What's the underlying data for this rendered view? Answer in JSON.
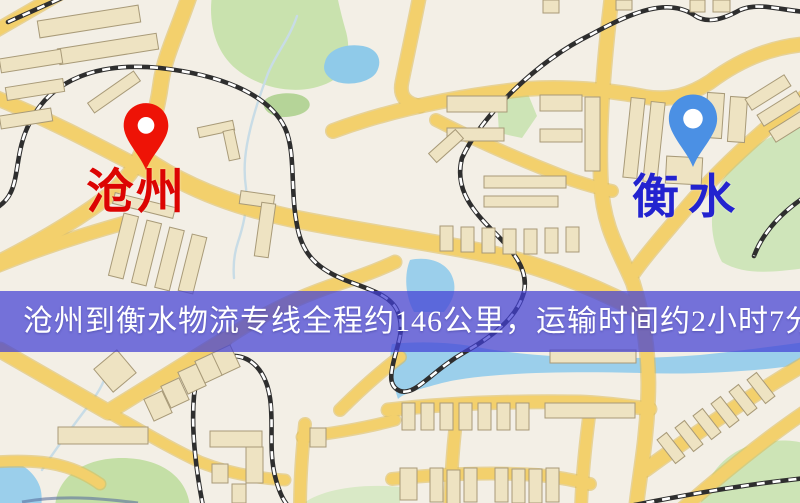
{
  "banner": {
    "text": "沧州到衡水物流专线全程约146公里，运输时间约2小时7分钟.",
    "background_rgba": "rgba(66,64,212,0.72)",
    "text_color": "#ffffff"
  },
  "route": {
    "origin": "沧州",
    "destination": "衡水",
    "distance_text": "约146公里",
    "duration_text": "约2小时7分钟"
  },
  "markers": {
    "cangzhou": {
      "label": "沧州",
      "pin_color": "#ee1306",
      "label_color": "#dc0402"
    },
    "hengshui": {
      "label": "衡水",
      "pin_color": "#4b90e4",
      "label_color": "#2323cf"
    }
  },
  "map_colors": {
    "background": "#f3efe6",
    "road_fill": "#f3d06c",
    "road_border": "#ddb954",
    "water": "#9bcfeb",
    "lake": "#8fcae9",
    "green_area": "#cbe3b1",
    "building_fill": "#eee3c2",
    "building_stroke": "#a89a78",
    "railway": "#2e2e2e",
    "stream": "#c8dce6"
  }
}
